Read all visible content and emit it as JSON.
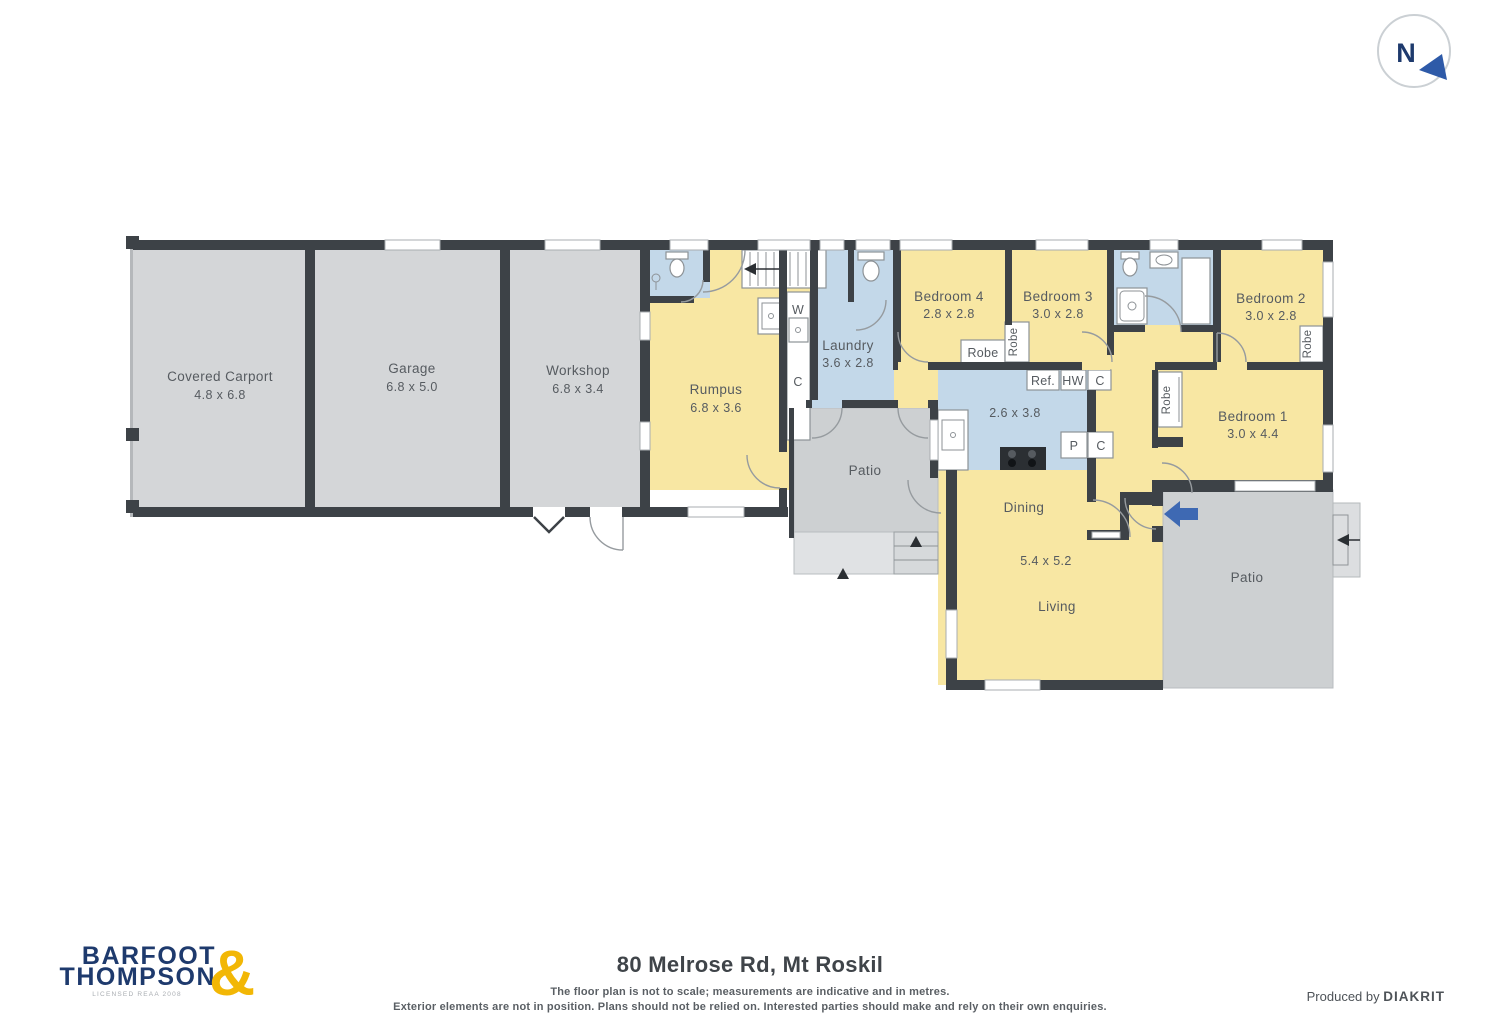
{
  "compass": {
    "label": "N"
  },
  "plan": {
    "rooms": {
      "carport": {
        "name": "Covered Carport",
        "dims": "4.8 x 6.8"
      },
      "garage": {
        "name": "Garage",
        "dims": "6.8 x 5.0"
      },
      "workshop": {
        "name": "Workshop",
        "dims": "6.8 x 3.4"
      },
      "rumpus": {
        "name": "Rumpus",
        "dims": "6.8 x 3.6"
      },
      "laundry": {
        "name": "Laundry",
        "dims": "3.6 x 2.8"
      },
      "bedroom4": {
        "name": "Bedroom 4",
        "dims": "2.8 x 2.8"
      },
      "bedroom3": {
        "name": "Bedroom 3",
        "dims": "3.0 x 2.8"
      },
      "bedroom2": {
        "name": "Bedroom 2",
        "dims": "3.0 x 2.8"
      },
      "bedroom1": {
        "name": "Bedroom 1",
        "dims": "3.0 x 4.4"
      },
      "kitchen": {
        "dims": "2.6 x 3.8"
      },
      "dining": {
        "name": "Dining"
      },
      "living": {
        "name": "Living",
        "dims": "5.4 x 5.2"
      },
      "patio_middle": {
        "name": "Patio"
      },
      "patio_right": {
        "name": "Patio"
      }
    },
    "fixture_labels": {
      "robe": "Robe",
      "fridge": "Ref.",
      "hot_water": "HW",
      "cupboard": "C",
      "pantry": "P",
      "washer": "W"
    }
  },
  "footer": {
    "brand": {
      "line1": "BARFOOT",
      "line2": "THOMPSON",
      "ampersand": "&",
      "license": "LICENSED REAA 2008"
    },
    "address": "80 Melrose Rd, Mt Roskil",
    "disclaimer1": "The floor plan is not to scale; measurements are indicative and in metres.",
    "disclaimer2": "Exterior elements are not in position. Plans should not be relied on. Interested parties should make and rely on their own enquiries.",
    "produced_by": "Produced by",
    "producer": "DIAKRIT"
  },
  "colors": {
    "wall": "#3d4247",
    "room_yellow": "#f8e7a3",
    "wet_blue": "#c3d8e9",
    "outdoor_gray": "#cdd0d2",
    "brand_navy": "#1e3a6d",
    "brand_gold": "#f2b705",
    "entry_arrow": "#3e69b3"
  }
}
